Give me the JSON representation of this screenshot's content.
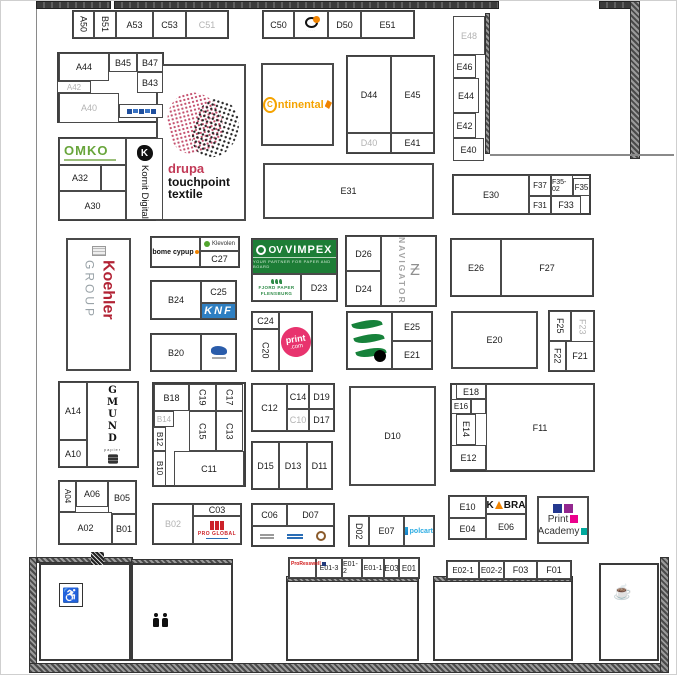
{
  "hall": {
    "name": "exhibition-hall-floor-plan"
  },
  "colors": {
    "drupa_red": "#c23a57",
    "continental_gold": "#f5a300",
    "vimpex_green": "#1d7d36",
    "omko_green": "#68a53b",
    "koehler_red": "#b22335",
    "printcom_pink": "#e8336e",
    "schoeller_green": "#17823b",
    "kobra_orange": "#f08300",
    "knf_blue": "#2e7fc2",
    "pa_blue": "#24388f",
    "pa_purple": "#93278f",
    "pa_pink": "#ec008c",
    "pa_teal": "#00a99d"
  },
  "brands": {
    "drupa": {
      "brand": "drupa",
      "l2": "touchpoint",
      "l3": "textile"
    },
    "continental": {
      "c": "C",
      "rest": "ntinental"
    },
    "omko": {
      "text": "OMKO"
    },
    "kornit": {
      "k": "K",
      "text": "Kornit Digital"
    },
    "koehler": {
      "name": "Koehler",
      "suffix": "GROUP"
    },
    "bome": {
      "text": "bome cypup"
    },
    "klevolen": {
      "text": "Klevolen"
    },
    "knf": {
      "text": "KNF"
    },
    "vimpex": {
      "prefix": "OV",
      "name": "VIMPEX",
      "tagline": "YOUR PARTNER FOR PAPER AND BOARD"
    },
    "fjord": {
      "l1": "FJORD PAPER",
      "l2": "FLENSBURG"
    },
    "printcom": {
      "top": "print",
      "bottom": ".com"
    },
    "navigator": {
      "text": "NAVIGATOR",
      "z": "Ƶ"
    },
    "gmund": {
      "letters": "G\nM\nU\nN\nD",
      "sub": "papier"
    },
    "kobra": {
      "k": "K",
      "rest": "BRA"
    },
    "print_academy": {
      "l1": "Print",
      "l2": "Academy"
    },
    "polcart": {
      "text": "polcart"
    },
    "redlogo": {
      "text": "PRO GLOBAL"
    },
    "pro": {
      "text": "ProResswell"
    },
    "ring": {
      "text": "·····"
    }
  },
  "icons": {
    "wheelchair": "♿",
    "coffee": "☕"
  },
  "plan": {
    "blocks": [
      [
        71,
        9,
        157,
        29
      ],
      [
        261,
        9,
        153,
        29
      ],
      [
        56,
        51,
        107,
        71
      ],
      [
        57,
        136,
        106,
        84
      ],
      [
        345,
        54,
        89,
        99
      ],
      [
        451,
        173,
        139,
        41
      ],
      [
        149,
        235,
        90,
        32
      ],
      [
        149,
        279,
        87,
        40
      ],
      [
        149,
        332,
        87,
        39
      ],
      [
        250,
        237,
        87,
        64
      ],
      [
        250,
        310,
        62,
        61
      ],
      [
        344,
        234,
        92,
        72
      ],
      [
        345,
        310,
        87,
        59
      ],
      [
        449,
        237,
        144,
        59
      ],
      [
        547,
        309,
        47,
        62
      ],
      [
        57,
        380,
        81,
        87
      ],
      [
        151,
        381,
        94,
        105
      ],
      [
        250,
        382,
        84,
        49
      ],
      [
        250,
        440,
        82,
        49
      ],
      [
        449,
        382,
        145,
        89
      ],
      [
        57,
        479,
        79,
        65
      ],
      [
        151,
        502,
        90,
        42
      ],
      [
        250,
        502,
        84,
        44
      ],
      [
        347,
        514,
        87,
        32
      ],
      [
        447,
        494,
        79,
        45
      ],
      [
        287,
        556,
        132,
        22
      ],
      [
        445,
        559,
        126,
        20
      ]
    ],
    "booths": [
      {
        "id": "A50",
        "x": 72,
        "y": 10,
        "w": 21,
        "h": 27,
        "rot": 1
      },
      {
        "id": "B51",
        "x": 93,
        "y": 10,
        "w": 22,
        "h": 27,
        "rot": 1
      },
      {
        "id": "A53",
        "x": 115,
        "y": 10,
        "w": 37,
        "h": 27
      },
      {
        "id": "C53",
        "x": 152,
        "y": 10,
        "w": 33,
        "h": 27
      },
      {
        "id": "C51",
        "x": 185,
        "y": 10,
        "w": 42,
        "h": 27,
        "dim": 1
      },
      {
        "id": "C50",
        "x": 262,
        "y": 10,
        "w": 31,
        "h": 27
      },
      {
        "id": "D50",
        "x": 327,
        "y": 10,
        "w": 33,
        "h": 27
      },
      {
        "id": "E51",
        "x": 360,
        "y": 10,
        "w": 53,
        "h": 27
      },
      {
        "id": "E48",
        "x": 452,
        "y": 15,
        "w": 32,
        "h": 39,
        "dim": 1
      },
      {
        "id": "E46",
        "x": 452,
        "y": 54,
        "w": 23,
        "h": 23
      },
      {
        "id": "E44",
        "x": 452,
        "y": 77,
        "w": 26,
        "h": 35
      },
      {
        "id": "E42",
        "x": 452,
        "y": 112,
        "w": 23,
        "h": 25
      },
      {
        "id": "E40",
        "x": 452,
        "y": 137,
        "w": 31,
        "h": 23
      },
      {
        "id": "A44",
        "x": 58,
        "y": 52,
        "w": 50,
        "h": 28
      },
      {
        "id": "B45",
        "x": 108,
        "y": 52,
        "w": 28,
        "h": 19
      },
      {
        "id": "B47",
        "x": 136,
        "y": 52,
        "w": 26,
        "h": 19
      },
      {
        "id": "B43",
        "x": 136,
        "y": 71,
        "w": 26,
        "h": 21
      },
      {
        "id": "A42",
        "x": 56,
        "y": 80,
        "w": 34,
        "h": 12,
        "dim": 1,
        "s": 8
      },
      {
        "id": "A40",
        "x": 58,
        "y": 92,
        "w": 60,
        "h": 30,
        "dim": 1
      },
      {
        "id": "A32",
        "x": 58,
        "y": 164,
        "w": 42,
        "h": 26
      },
      {
        "id": "",
        "x": 100,
        "y": 164,
        "w": 25,
        "h": 26
      },
      {
        "id": "A30",
        "x": 58,
        "y": 190,
        "w": 67,
        "h": 29
      },
      {
        "id": "D44",
        "x": 346,
        "y": 55,
        "w": 44,
        "h": 77
      },
      {
        "id": "E45",
        "x": 390,
        "y": 55,
        "w": 43,
        "h": 77
      },
      {
        "id": "D40",
        "x": 346,
        "y": 132,
        "w": 44,
        "h": 20,
        "dim": 1
      },
      {
        "id": "E41",
        "x": 390,
        "y": 132,
        "w": 43,
        "h": 20
      },
      {
        "id": "E31",
        "x": 262,
        "y": 162,
        "w": 171,
        "h": 56,
        "b": 1
      },
      {
        "id": "E30",
        "x": 452,
        "y": 174,
        "w": 76,
        "h": 39
      },
      {
        "id": "F37",
        "x": 528,
        "y": 174,
        "w": 22,
        "h": 21,
        "s": 8
      },
      {
        "id": "F35-02",
        "x": 550,
        "y": 174,
        "w": 22,
        "h": 21,
        "s": 7
      },
      {
        "id": "F35",
        "x": 572,
        "y": 177,
        "w": 17,
        "h": 18,
        "s": 8
      },
      {
        "id": "F31",
        "x": 528,
        "y": 195,
        "w": 22,
        "h": 18,
        "s": 8
      },
      {
        "id": "F33",
        "x": 550,
        "y": 195,
        "w": 30,
        "h": 18
      },
      {
        "id": "C27",
        "x": 199,
        "y": 250,
        "w": 39,
        "h": 16
      },
      {
        "id": "B24",
        "x": 150,
        "y": 280,
        "w": 50,
        "h": 38
      },
      {
        "id": "C25",
        "x": 200,
        "y": 280,
        "w": 35,
        "h": 22
      },
      {
        "id": "B20",
        "x": 150,
        "y": 333,
        "w": 50,
        "h": 37
      },
      {
        "id": "D23",
        "x": 300,
        "y": 273,
        "w": 36,
        "h": 27
      },
      {
        "id": "C24",
        "x": 251,
        "y": 311,
        "w": 27,
        "h": 17
      },
      {
        "id": "C20",
        "x": 251,
        "y": 328,
        "w": 27,
        "h": 42,
        "rot": 1
      },
      {
        "id": "D26",
        "x": 345,
        "y": 235,
        "w": 35,
        "h": 35
      },
      {
        "id": "D24",
        "x": 345,
        "y": 270,
        "w": 35,
        "h": 35
      },
      {
        "id": "E25",
        "x": 391,
        "y": 311,
        "w": 40,
        "h": 29
      },
      {
        "id": "E21",
        "x": 391,
        "y": 340,
        "w": 40,
        "h": 28
      },
      {
        "id": "E26",
        "x": 450,
        "y": 238,
        "w": 50,
        "h": 57
      },
      {
        "id": "F27",
        "x": 500,
        "y": 238,
        "w": 92,
        "h": 57
      },
      {
        "id": "E20",
        "x": 450,
        "y": 310,
        "w": 87,
        "h": 58,
        "b": 1
      },
      {
        "id": "F25",
        "x": 548,
        "y": 310,
        "w": 22,
        "h": 30,
        "rot": 1
      },
      {
        "id": "F23",
        "x": 570,
        "y": 310,
        "w": 23,
        "h": 32,
        "rot": 1,
        "dim": 1
      },
      {
        "id": "F22",
        "x": 548,
        "y": 340,
        "w": 17,
        "h": 30,
        "rot": 1
      },
      {
        "id": "F21",
        "x": 565,
        "y": 340,
        "w": 28,
        "h": 30
      },
      {
        "id": "A14",
        "x": 58,
        "y": 381,
        "w": 28,
        "h": 58
      },
      {
        "id": "A10",
        "x": 58,
        "y": 439,
        "w": 28,
        "h": 27
      },
      {
        "id": "B18",
        "x": 153,
        "y": 383,
        "w": 35,
        "h": 27
      },
      {
        "id": "C19",
        "x": 188,
        "y": 383,
        "w": 27,
        "h": 27,
        "rot": 1
      },
      {
        "id": "C17",
        "x": 215,
        "y": 383,
        "w": 27,
        "h": 27,
        "rot": 1
      },
      {
        "id": "B14",
        "x": 153,
        "y": 410,
        "w": 20,
        "h": 16,
        "dim": 1,
        "s": 8
      },
      {
        "id": "B12",
        "x": 152,
        "y": 426,
        "w": 13,
        "h": 24,
        "rot": 1,
        "s": 8
      },
      {
        "id": "C15",
        "x": 188,
        "y": 410,
        "w": 27,
        "h": 40,
        "rot": 1
      },
      {
        "id": "C13",
        "x": 215,
        "y": 410,
        "w": 27,
        "h": 40,
        "rot": 1
      },
      {
        "id": "B10",
        "x": 152,
        "y": 450,
        "w": 13,
        "h": 35,
        "rot": 1,
        "s": 8
      },
      {
        "id": "C11",
        "x": 173,
        "y": 450,
        "w": 70,
        "h": 35
      },
      {
        "id": "C12",
        "x": 251,
        "y": 383,
        "w": 35,
        "h": 47
      },
      {
        "id": "C14",
        "x": 286,
        "y": 383,
        "w": 22,
        "h": 25
      },
      {
        "id": "D19",
        "x": 308,
        "y": 383,
        "w": 25,
        "h": 25
      },
      {
        "id": "C10",
        "x": 286,
        "y": 408,
        "w": 22,
        "h": 22,
        "dim": 1
      },
      {
        "id": "D17",
        "x": 308,
        "y": 408,
        "w": 25,
        "h": 22
      },
      {
        "id": "D15",
        "x": 251,
        "y": 441,
        "w": 27,
        "h": 47
      },
      {
        "id": "D13",
        "x": 278,
        "y": 441,
        "w": 28,
        "h": 47
      },
      {
        "id": "D11",
        "x": 306,
        "y": 441,
        "w": 25,
        "h": 47
      },
      {
        "id": "D10",
        "x": 348,
        "y": 385,
        "w": 87,
        "h": 100,
        "b": 1
      },
      {
        "id": "E18",
        "x": 455,
        "y": 383,
        "w": 30,
        "h": 15
      },
      {
        "id": "E16",
        "x": 450,
        "y": 398,
        "w": 20,
        "h": 15,
        "s": 8
      },
      {
        "id": "",
        "x": 470,
        "y": 398,
        "w": 15,
        "h": 15
      },
      {
        "id": "E14",
        "x": 455,
        "y": 413,
        "w": 20,
        "h": 31,
        "rot": 1
      },
      {
        "id": "E12",
        "x": 450,
        "y": 444,
        "w": 35,
        "h": 25
      },
      {
        "id": "F11",
        "x": 485,
        "y": 383,
        "w": 108,
        "h": 87
      },
      {
        "id": "A04",
        "x": 58,
        "y": 480,
        "w": 17,
        "h": 31,
        "rot": 1,
        "s": 8
      },
      {
        "id": "A06",
        "x": 75,
        "y": 480,
        "w": 32,
        "h": 26
      },
      {
        "id": "B05",
        "x": 107,
        "y": 480,
        "w": 28,
        "h": 33
      },
      {
        "id": "A02",
        "x": 58,
        "y": 511,
        "w": 53,
        "h": 32
      },
      {
        "id": "B01",
        "x": 111,
        "y": 513,
        "w": 24,
        "h": 30
      },
      {
        "id": "B02",
        "x": 152,
        "y": 503,
        "w": 40,
        "h": 40,
        "dim": 1
      },
      {
        "id": "C03",
        "x": 192,
        "y": 503,
        "w": 48,
        "h": 12
      },
      {
        "id": "C06",
        "x": 251,
        "y": 503,
        "w": 35,
        "h": 22
      },
      {
        "id": "D07",
        "x": 286,
        "y": 503,
        "w": 47,
        "h": 22
      },
      {
        "id": "D02",
        "x": 348,
        "y": 515,
        "w": 20,
        "h": 30,
        "rot": 1
      },
      {
        "id": "E07",
        "x": 368,
        "y": 515,
        "w": 35,
        "h": 30
      },
      {
        "id": "E10",
        "x": 448,
        "y": 495,
        "w": 37,
        "h": 22
      },
      {
        "id": "E04",
        "x": 448,
        "y": 517,
        "w": 37,
        "h": 21
      },
      {
        "id": "E06",
        "x": 485,
        "y": 513,
        "w": 40,
        "h": 25
      },
      {
        "id": "",
        "x": 288,
        "y": 557,
        "w": 27,
        "h": 20
      },
      {
        "id": "E01-3",
        "x": 315,
        "y": 557,
        "w": 26,
        "h": 20,
        "s": 7
      },
      {
        "id": "E01-2",
        "x": 341,
        "y": 557,
        "w": 20,
        "h": 20,
        "s": 7
      },
      {
        "id": "E01-1",
        "x": 361,
        "y": 557,
        "w": 22,
        "h": 20,
        "s": 7
      },
      {
        "id": "E03",
        "x": 383,
        "y": 557,
        "w": 15,
        "h": 20,
        "s": 8
      },
      {
        "id": "E01",
        "x": 398,
        "y": 557,
        "w": 20,
        "h": 20,
        "s": 8
      },
      {
        "id": "E02-1",
        "x": 446,
        "y": 560,
        "w": 32,
        "h": 18,
        "s": 8
      },
      {
        "id": "E02-2",
        "x": 478,
        "y": 560,
        "w": 25,
        "h": 18,
        "s": 8
      },
      {
        "id": "F03",
        "x": 503,
        "y": 560,
        "w": 33,
        "h": 18
      },
      {
        "id": "F01",
        "x": 536,
        "y": 560,
        "w": 34,
        "h": 18
      }
    ]
  }
}
